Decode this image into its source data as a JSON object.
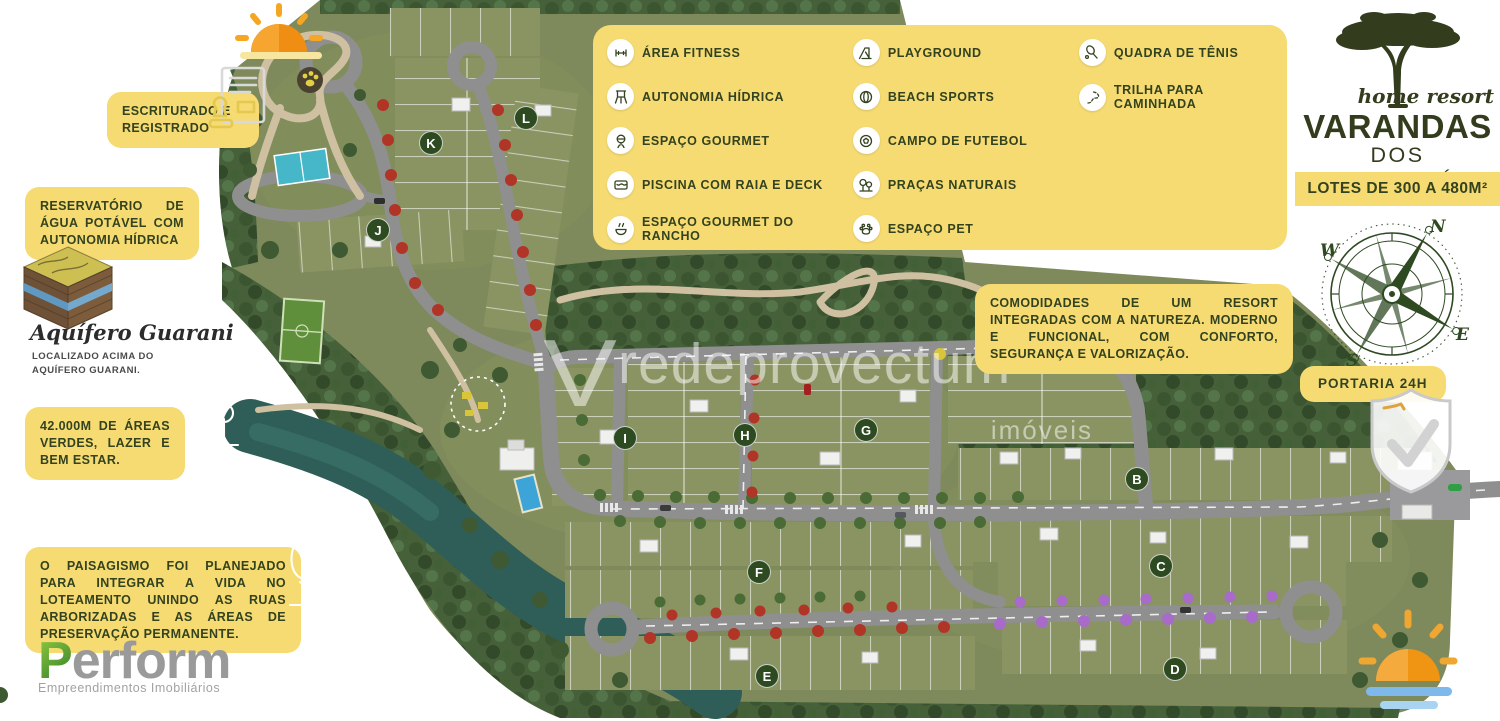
{
  "branding": {
    "tagline_script": "home resort",
    "name_line1": "VARANDAS",
    "name_line2": "DOS JEQUITIBÁS",
    "banner": "LOTES DE 300 A 480M²",
    "colors": {
      "accent_yellow": "#F6DB72",
      "brand_green": "#333D1D",
      "map_grass": "#7E8A5B",
      "forest_green": "#46613A",
      "river_teal": "#2E5E57",
      "road_gray": "#8F8F90",
      "perform_green": "#4F9E33"
    }
  },
  "amenities_panel": {
    "items": [
      {
        "label": "ÁREA FITNESS",
        "icon": "dumbbell-icon"
      },
      {
        "label": "PLAYGROUND",
        "icon": "playground-icon"
      },
      {
        "label": "QUADRA DE TÊNIS",
        "icon": "tennis-racket-icon"
      },
      {
        "label": "AUTONOMIA HÍDRICA",
        "icon": "water-tower-icon"
      },
      {
        "label": "BEACH SPORTS",
        "icon": "beach-ball-icon"
      },
      {
        "label": "TRILHA PARA CAMINHADA",
        "icon": "trail-icon"
      },
      {
        "label": "ESPAÇO GOURMET",
        "icon": "grill-icon"
      },
      {
        "label": "CAMPO DE FUTEBOL",
        "icon": "soccer-ball-icon"
      },
      {
        "label": "PISCINA COM RAIA E DECK",
        "icon": "pool-icon"
      },
      {
        "label": "PRAÇAS NATURAIS",
        "icon": "park-trees-icon"
      },
      {
        "label": "ESPAÇO GOURMET DO RANCHO",
        "icon": "rancho-bowl-icon"
      },
      {
        "label": "ESPAÇO PET",
        "icon": "paw-icon"
      }
    ]
  },
  "callouts": {
    "escriturado": "ESCRITURADO E REGISTRADO",
    "reservatorio": "RESERVATÓRIO DE ÁGUA POTÁVEL COM AUTONOMIA HÍDRICA",
    "aquifero_title": "Aquífero Guarani",
    "aquifero_sub": "LOCALIZADO ACIMA DO AQUÍFERO GUARANI.",
    "areas_verdes": "42.000M DE ÁREAS VERDES, LAZER E BEM ESTAR.",
    "paisagismo": "O PAISAGISMO FOI PLANEJADO PARA INTEGRAR A VIDA NO LOTEAMENTO UNINDO AS RUAS ARBORIZADAS E AS ÁREAS DE PRESERVAÇÃO PERMANENTE.",
    "comodidades": "COMODIDADES DE UM RESORT INTEGRADAS COM A NATUREZA. MODERNO E FUNCIONAL, COM CONFORTO, SEGURANÇA E VALORIZAÇÃO.",
    "portaria": "PORTARIA 24H"
  },
  "developer": {
    "logo_p": "P",
    "logo_rest": "erform",
    "tagline": "Empreendimentos Imobiliários"
  },
  "watermark": {
    "mark": "V",
    "line1": "redeprovectum",
    "line2": "imóveis"
  },
  "map": {
    "blocks": [
      "K",
      "L",
      "J",
      "I",
      "H",
      "G",
      "F",
      "E",
      "B",
      "C",
      "D"
    ],
    "features": [
      "tennis-court",
      "walking-trail",
      "soccer-field",
      "playground",
      "clubhouse-pool",
      "river",
      "entrance-gate"
    ]
  }
}
